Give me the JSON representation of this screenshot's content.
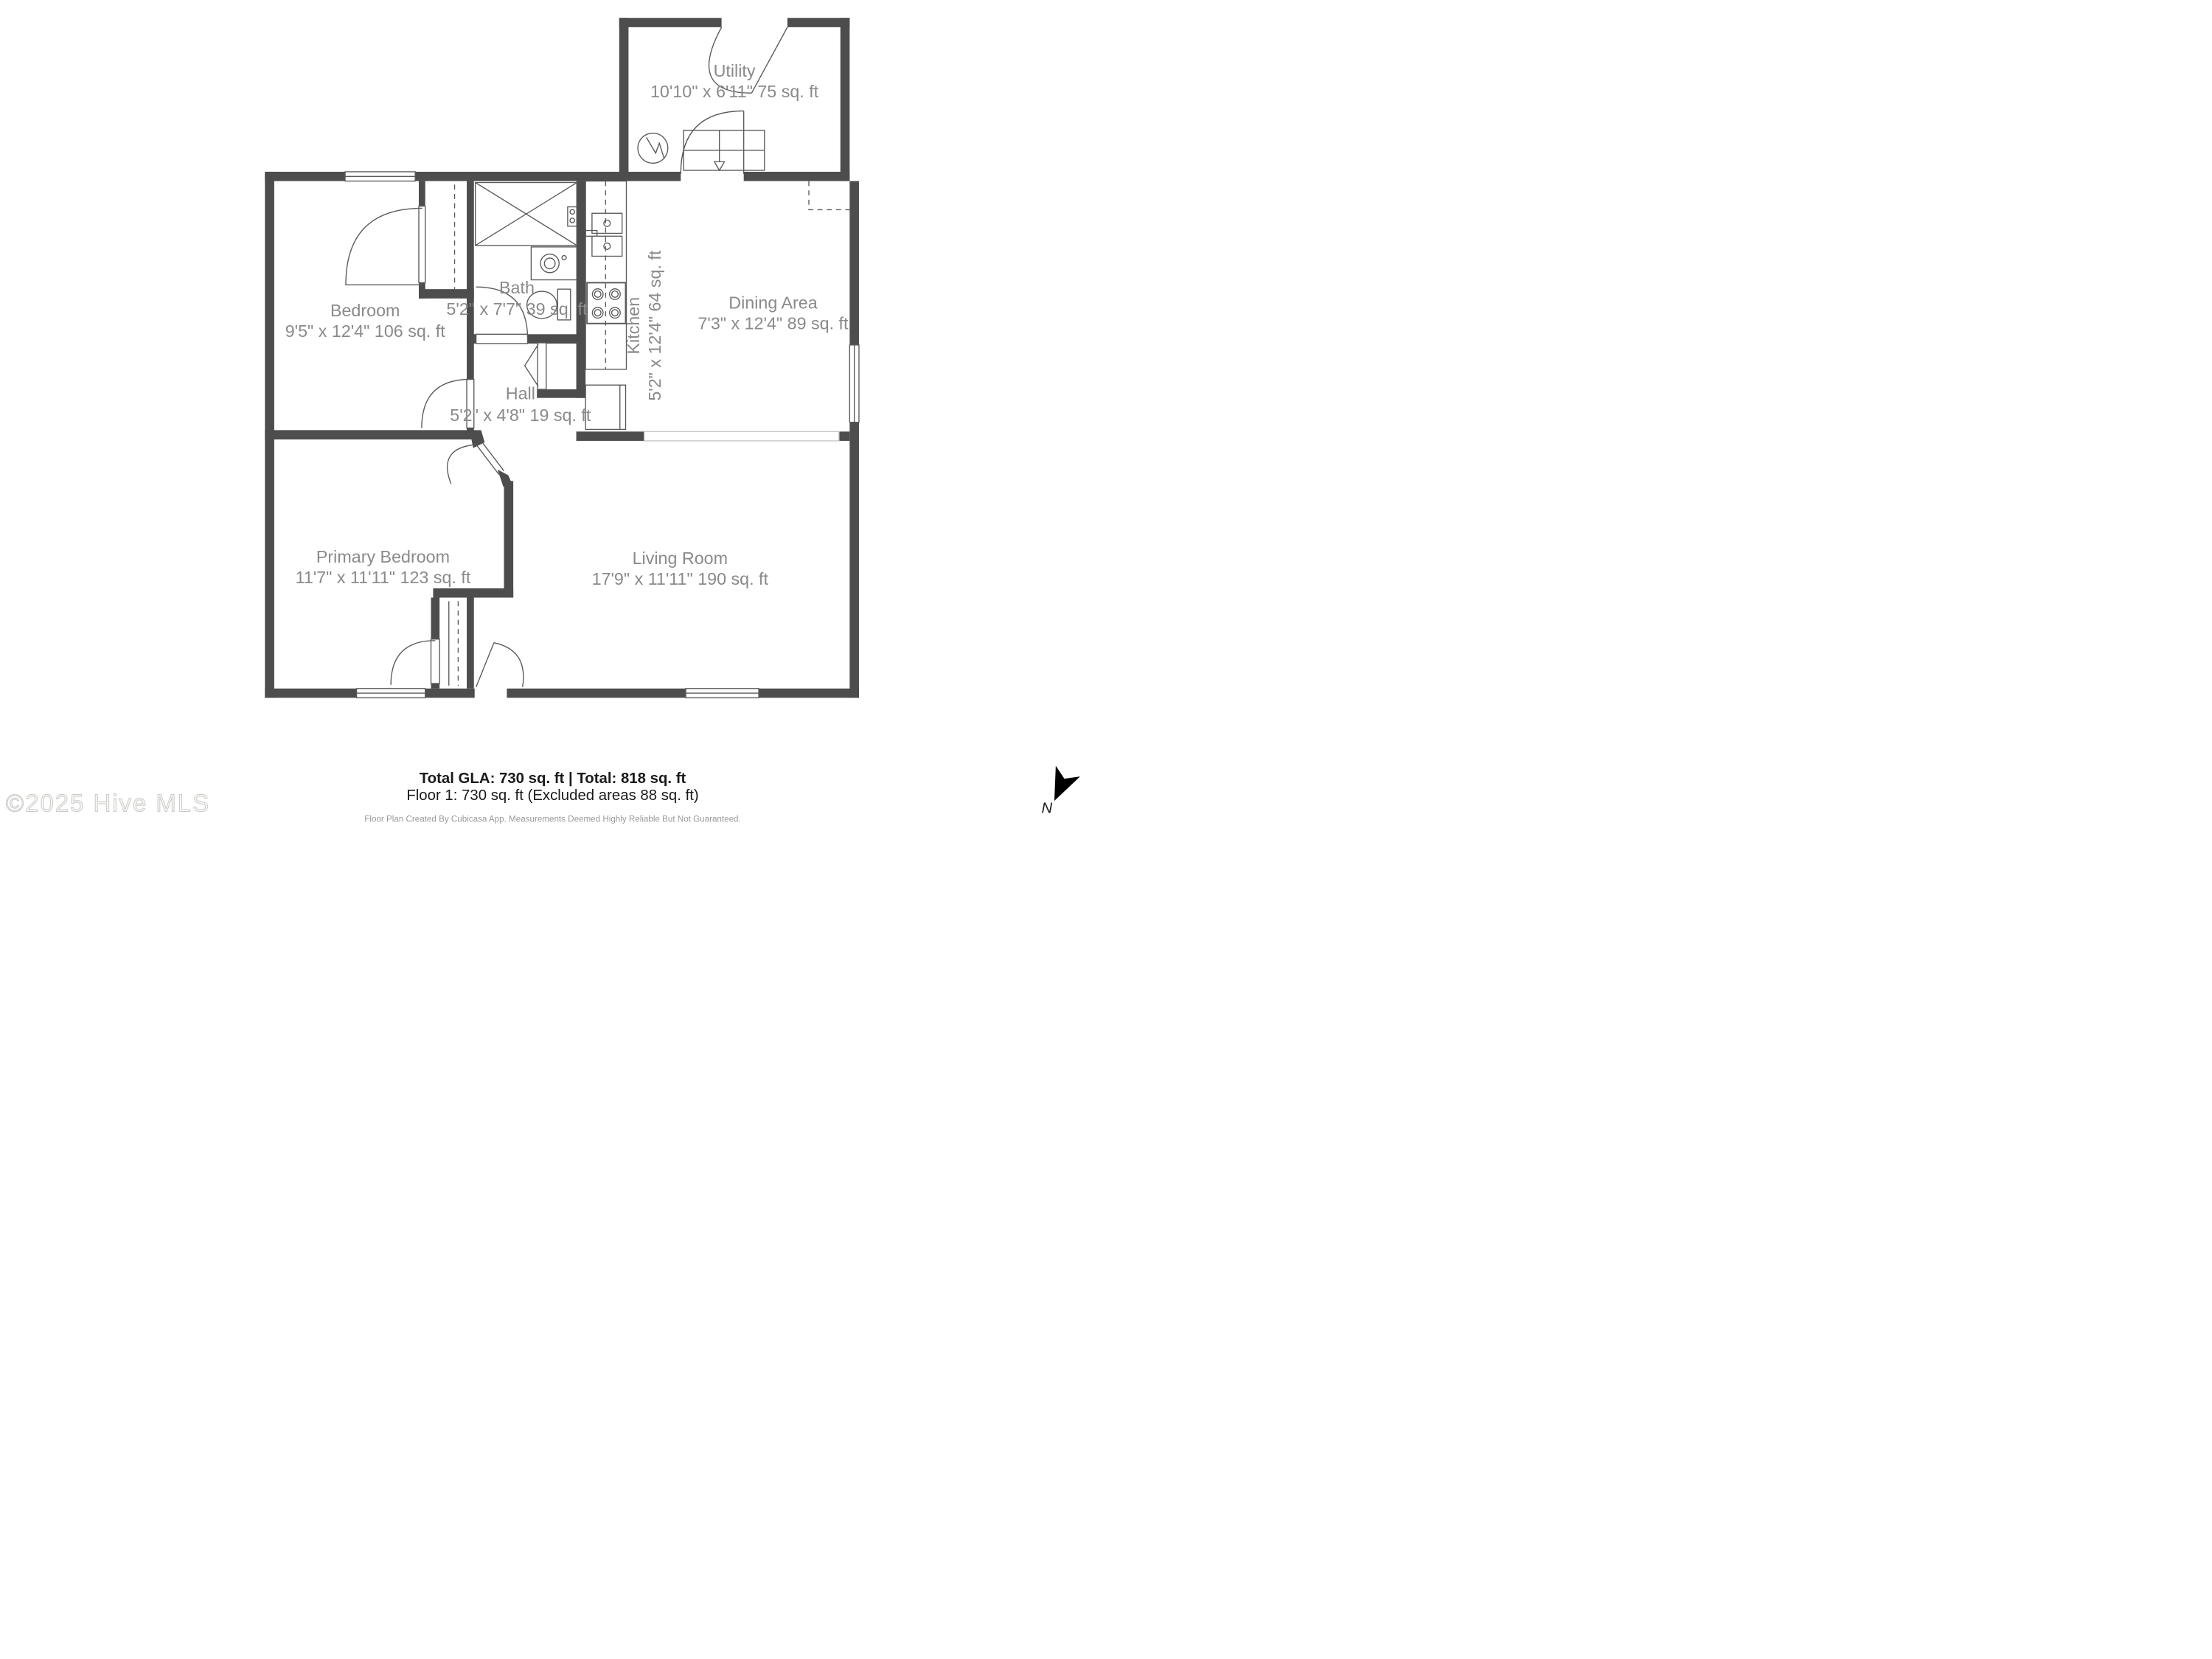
{
  "colors": {
    "wall": "#4D4D4D",
    "line": "#5A5A5A",
    "label": "#8A8A8A",
    "divider": "#C9C9C9",
    "text_dark": "#1A1A1A",
    "muted": "#9A9A9A",
    "watermark_fill": "#F7F7F5",
    "watermark_stroke": "#C9C9C6",
    "north": "#000000"
  },
  "rooms": [
    {
      "name": "Utility",
      "dims": "10'10\" x 6'11\" 75 sq. ft"
    },
    {
      "name": "Bedroom",
      "dims": "9'5\" x 12'4\" 106 sq. ft"
    },
    {
      "name": "Bath",
      "dims": "5'2\" x 7'7\" 39 sq. ft"
    },
    {
      "name": "Kitchen",
      "dims": "5'2\" x 12'4\" 64 sq. ft"
    },
    {
      "name": "Dining Area",
      "dims": "7'3\" x 12'4\" 89 sq. ft"
    },
    {
      "name": "Hall",
      "dims": "5'2\" x 4'8\" 19 sq. ft"
    },
    {
      "name": "Primary Bedroom",
      "dims": "11'7\" x 11'11\" 123 sq. ft"
    },
    {
      "name": "Living Room",
      "dims": "17'9\" x 11'11\" 190 sq. ft"
    }
  ],
  "footer": {
    "totals": "Total GLA: 730 sq. ft | Total: 818 sq. ft",
    "floor1": "Floor 1: 730 sq. ft (Excluded areas 88 sq. ft)",
    "disclaimer": "Floor Plan Created By Cubicasa App. Measurements Deemed Highly Reliable But Not Guaranteed."
  },
  "watermark": "©2025 Hive MLS",
  "compass": {
    "label": "N"
  }
}
